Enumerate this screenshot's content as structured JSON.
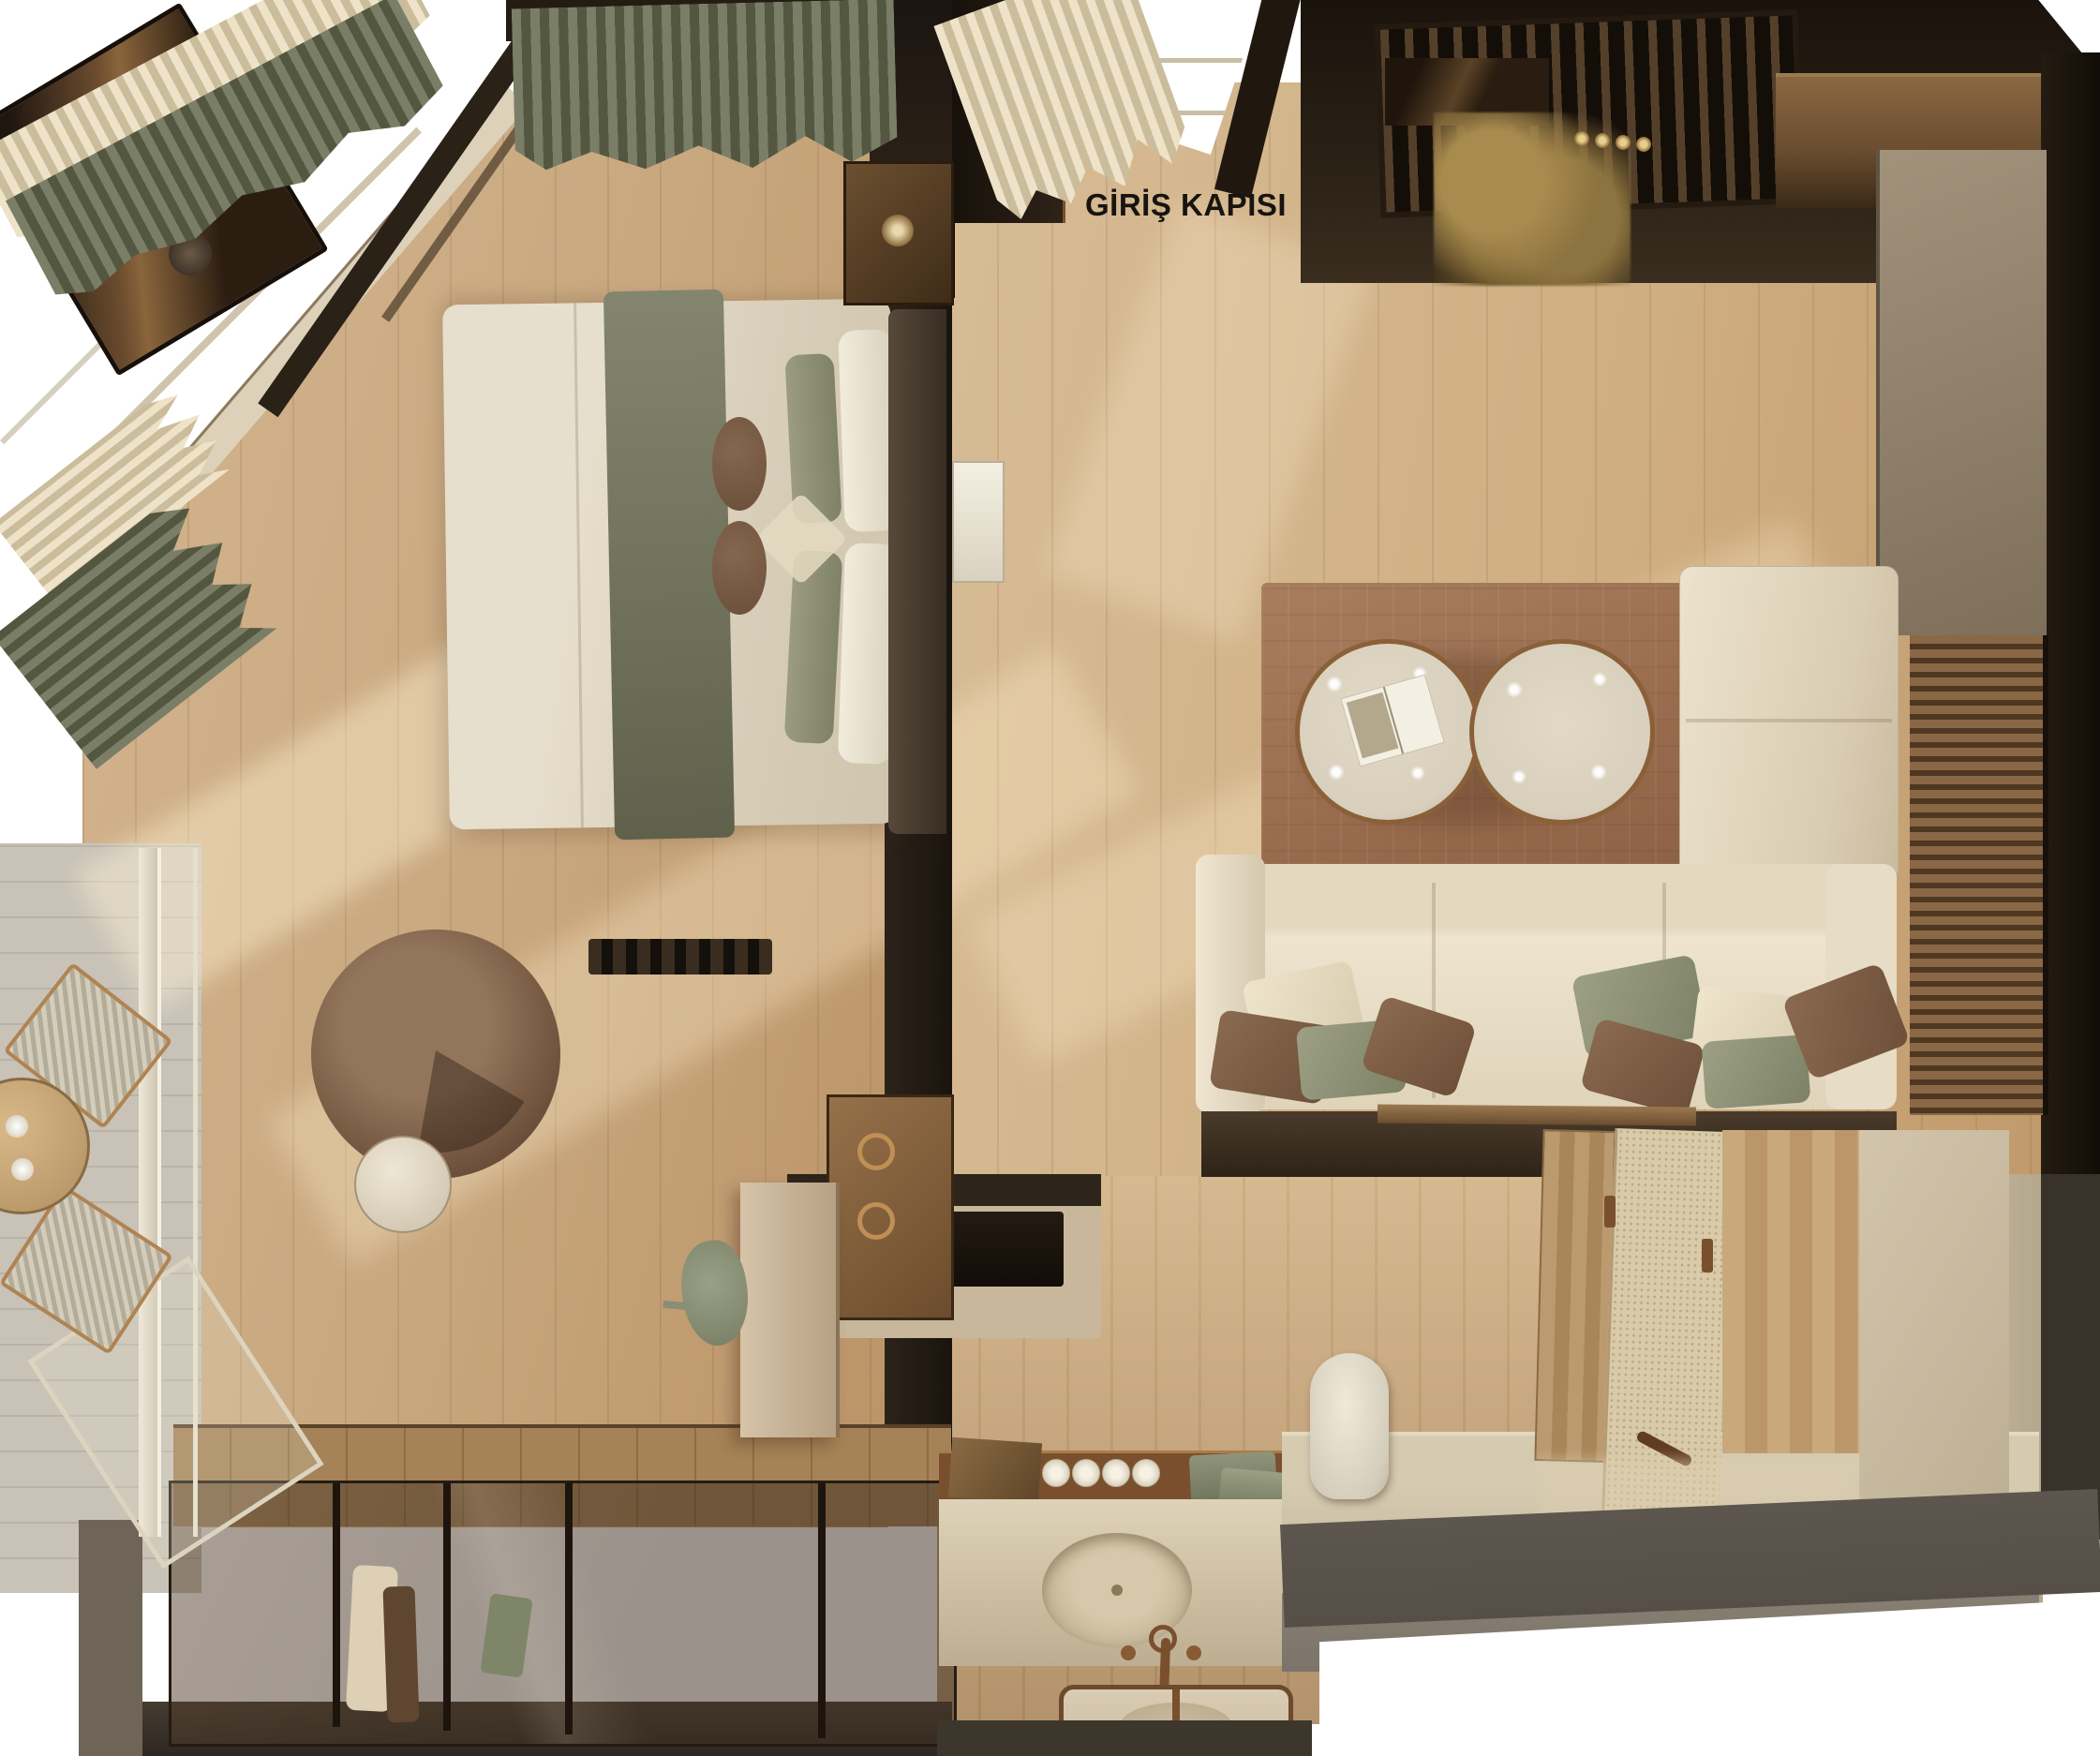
{
  "labels": {
    "entrance": "GİRİŞ KAPISI"
  },
  "colors": {
    "white": "#ffffff",
    "label_color": "#171411",
    "floor_a": "#d5b78f",
    "floor_b": "#c19a6c",
    "bath_plank_a": "#c9a87e",
    "bath_plank_b": "#bd9a6e",
    "balcony_a": "#c8c2b7",
    "balcony_b": "#b8b2a7",
    "wall_dark": "#241c13",
    "wall_mid": "#3a2f21",
    "wall_char": "#554f47",
    "taupe_a": "#a2927c",
    "taupe_b": "#7e6f5b",
    "stone_a": "#d6cab1",
    "stone_b": "#c0b298",
    "stone_front": "#7c746a",
    "rug_a": "#a87d5e",
    "rug_b": "#8a5f44",
    "sofa_a": "#ece2cd",
    "sofa_b": "#d5c8ae",
    "pil_cream": "#e9dec6",
    "pil_sage": "#8d9073",
    "pil_brown": "#7a5a43",
    "duvet_a": "#e7dfcd",
    "duvet_b": "#cfc4ad",
    "throw_a": "#83856f",
    "throw_b": "#5f614c",
    "headboard": "#4a3e31",
    "wood_dk": "#3a2814",
    "wood_md": "#8a6742",
    "wood_lt": "#bb9a70",
    "bronze": "#7a4f2e",
    "bronze_lt": "#c08f55",
    "gold": "#a88b4e",
    "cur_cr_a": "#eee3c8",
    "cur_cr_b": "#cbbd9c",
    "cur_ol_a": "#7b7e67",
    "cur_ol_b": "#535740",
    "glass": "rgba(62,46,32,.52)",
    "closet_wood": "#a58257",
    "slat_a": "#8a6845",
    "slat_b": "#4e3822",
    "green_chair": "#868d6f",
    "desk_beige": "#cdb99c",
    "table_stone": "#d9cfbd",
    "niche": "#c8b79a",
    "speckle": "#d9caa8"
  },
  "scene": {
    "view": "top-down interior render",
    "rooms": [
      "bedroom",
      "living-area",
      "entrance-corridor",
      "kitchenette",
      "bathroom",
      "wardrobe",
      "balcony"
    ],
    "objects": [
      "double-bed",
      "olive-throw",
      "pillows",
      "headboard",
      "nightstands",
      "luggage-bench",
      "swivel-armchair",
      "side-table",
      "writing-desk",
      "desk-chair",
      "corner-sofa",
      "scatter-cushions",
      "round-coffee-tables",
      "open-magazine",
      "area-rug",
      "slat-accent-wall",
      "entrance-door",
      "skylight",
      "gold-dried-plant",
      "bar-glasses",
      "vanity-counter",
      "oval-sink",
      "bronze-faucet",
      "mirror",
      "towel-rolls",
      "green-towels",
      "stone-bench",
      "ceramic-vase",
      "shower-enclosure",
      "glass-wardrobe",
      "hanging-clothes",
      "balcony-chairs",
      "balcony-table",
      "cups",
      "curtains-cream",
      "curtains-olive"
    ]
  }
}
